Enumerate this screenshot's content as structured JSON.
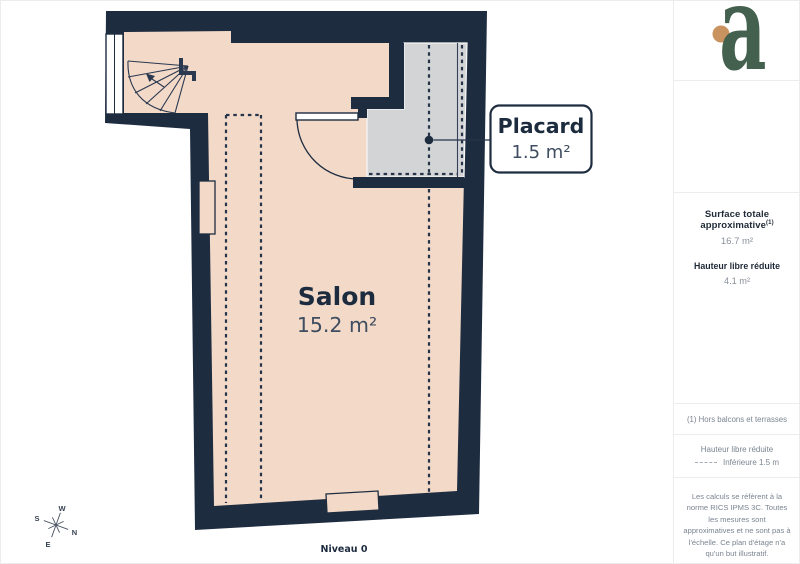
{
  "plan": {
    "level": "Niveau 0",
    "salon": {
      "name": "Salon",
      "area": "15.2 m²"
    },
    "placard": {
      "name": "Placard",
      "area": "1.5 m²"
    },
    "compass": {
      "n": "N",
      "e": "E",
      "s": "S",
      "w": "W"
    }
  },
  "sidebar": {
    "logo_letter": "a",
    "surface": {
      "title": "Surface totale approximative",
      "sup": "(1)",
      "value": "16.7 m²"
    },
    "height": {
      "title": "Hauteur libre réduite",
      "value": "4.1 m²"
    },
    "footnote": "(1) Hors balcons et terrasses",
    "legend": {
      "title": "Hauteur libre réduite",
      "item": "Inférieure 1.5 m"
    },
    "disclaimer": "Les calculs se réfèrent à la norme RICS IPMS 3C. Toutes les mesures sont approximatives et ne sont pas à l'échelle. Ce plan d'étage n'a qu'un but illustratif.",
    "brand": {
      "name": "GIRAFFE",
      "suffix": "360"
    }
  },
  "colors": {
    "wall": "#1e2c40",
    "floor": "#f2d9c8",
    "closet": "#d3d4d6",
    "line": "#26344a",
    "logo_green": "#44604e",
    "logo_orange": "#c9935f"
  }
}
